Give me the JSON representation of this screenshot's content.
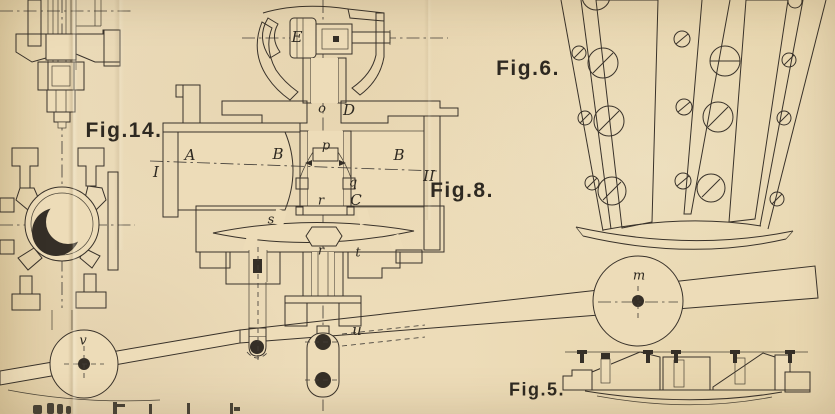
{
  "colors": {
    "paper": "#eddcb8",
    "paper_shadow": "#e2cfa5",
    "ink": "#39322a",
    "dark_fill": "#352f27"
  },
  "figure_labels": {
    "fig14": "Fig.14.",
    "fig8": "Fig.8.",
    "fig6": "Fig.6.",
    "fig5": "Fig.5."
  },
  "part_labels": {
    "E": "E",
    "o": "o",
    "D": "D",
    "A": "A",
    "B_left": "B",
    "B_right": "B",
    "section_I": "I",
    "section_II": "II",
    "p": "p",
    "q": "q",
    "C": "C",
    "r_upper": "r",
    "s": "s",
    "t": "t",
    "r_lower": "r",
    "u": "u",
    "wheel_m": "m",
    "wheel_v": "v"
  }
}
